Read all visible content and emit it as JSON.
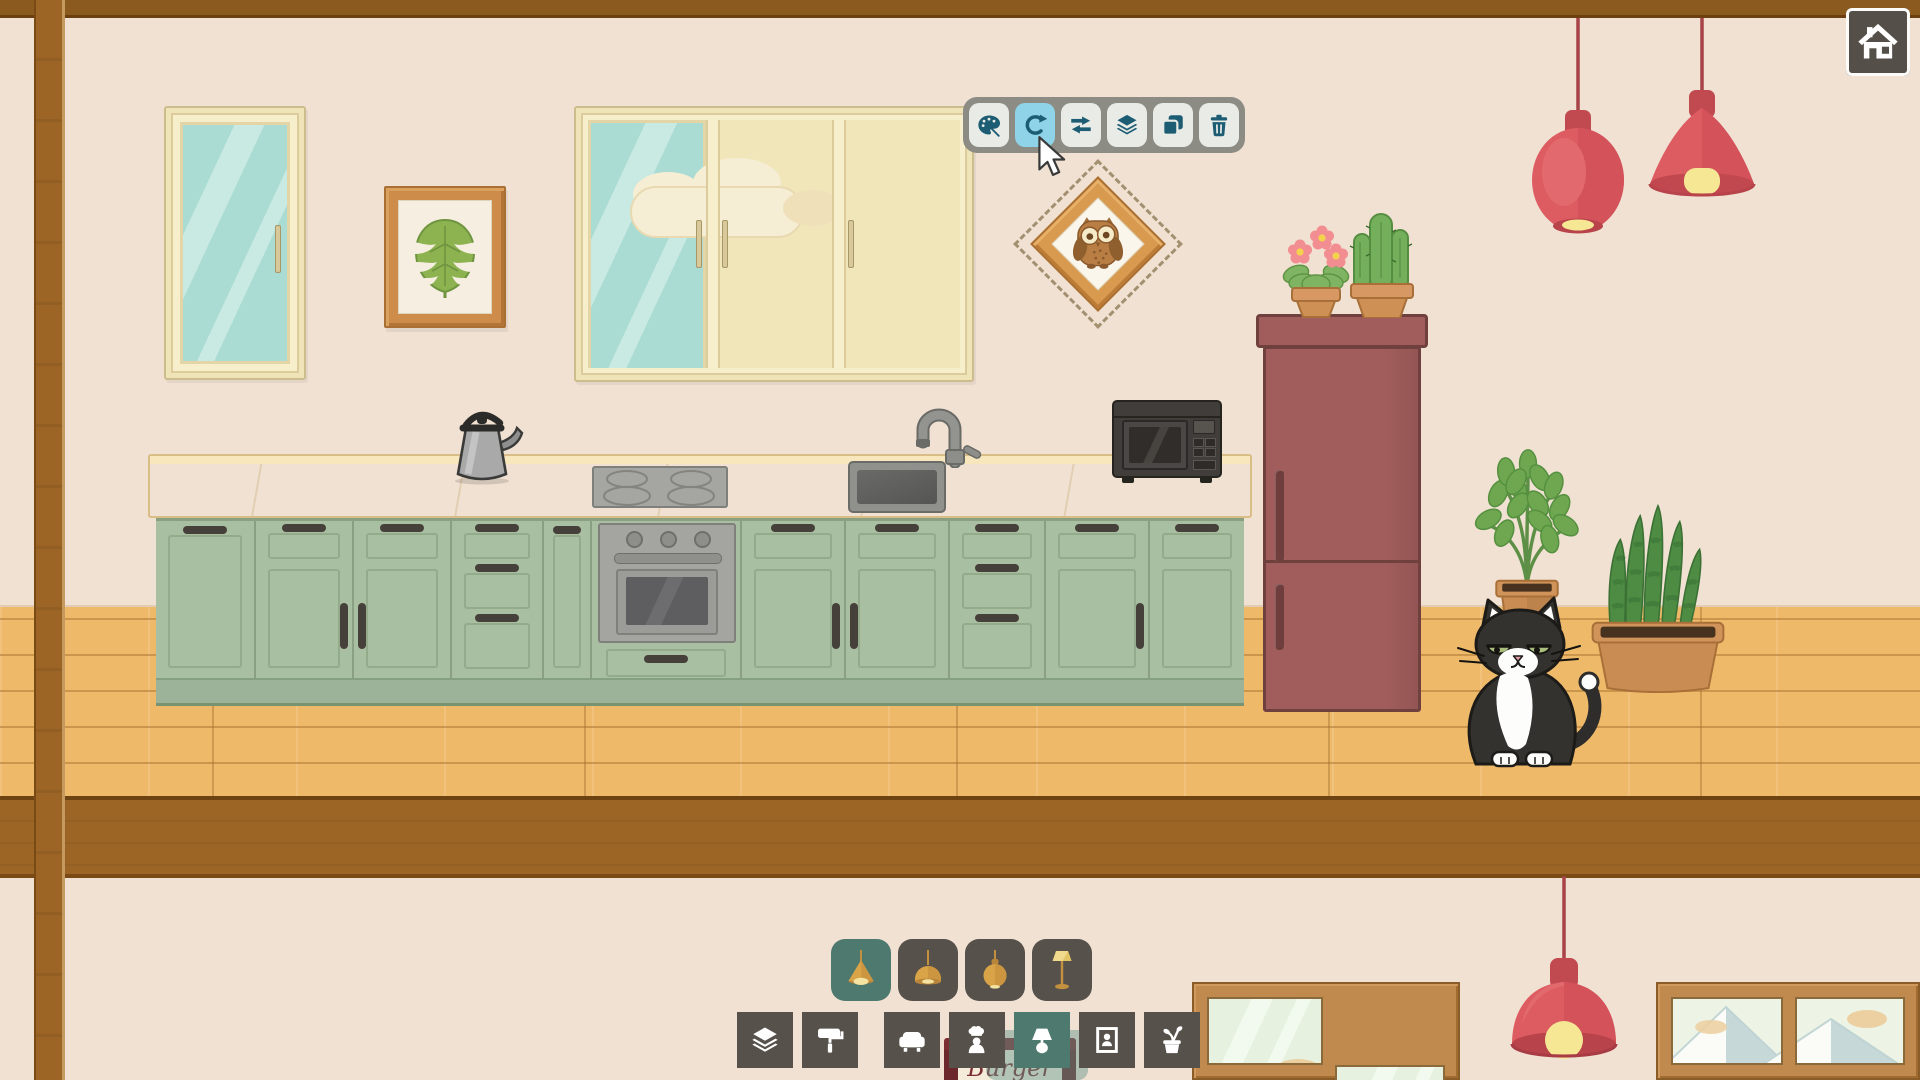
{
  "ui": {
    "home_button": {
      "icon": "home-icon"
    },
    "selection_toolbar": {
      "buttons": [
        {
          "id": "paint",
          "icon": "palette-icon",
          "active": false
        },
        {
          "id": "rotate",
          "icon": "rotate-icon",
          "active": true
        },
        {
          "id": "flip",
          "icon": "flip-arrows-icon",
          "active": false
        },
        {
          "id": "layers",
          "icon": "layers-icon",
          "active": false
        },
        {
          "id": "duplicate",
          "icon": "duplicate-icon",
          "active": false
        },
        {
          "id": "delete",
          "icon": "trash-icon",
          "active": false
        }
      ]
    },
    "item_tray": {
      "items": [
        {
          "id": "pendant-lamp-cone",
          "icon": "pendant-lamp-cone-icon",
          "selected": true
        },
        {
          "id": "pendant-lamp-dome",
          "icon": "pendant-lamp-dome-icon",
          "selected": false
        },
        {
          "id": "pendant-lamp-orb",
          "icon": "pendant-lamp-orb-icon",
          "selected": false
        },
        {
          "id": "floor-lamp",
          "icon": "floor-lamp-icon",
          "selected": false
        }
      ]
    },
    "category_bar": {
      "items": [
        {
          "id": "layers",
          "icon": "layers-icon",
          "selected": false
        },
        {
          "id": "wallpaper",
          "icon": "paint-roller-icon",
          "selected": false
        },
        {
          "id": "furniture",
          "icon": "couch-icon",
          "selected": false
        },
        {
          "id": "characters",
          "icon": "chef-icon",
          "selected": false
        },
        {
          "id": "lighting",
          "icon": "table-lamp-icon",
          "selected": true
        },
        {
          "id": "wall-decor",
          "icon": "framed-picture-icon",
          "selected": false
        },
        {
          "id": "plants",
          "icon": "potted-plant-icon",
          "selected": false
        }
      ]
    },
    "cursor": {
      "x": 1038,
      "y": 136
    }
  },
  "scene": {
    "selected_object": "owl-picture",
    "sign_text": "Burger",
    "upper_room_objects": [
      "single-window",
      "monstera-picture",
      "triple-window",
      "owl-picture",
      "kettle",
      "cooktop",
      "sink",
      "microwave",
      "oven",
      "kitchen-cabinets",
      "refrigerator",
      "flower-pot-plant",
      "cactus-plant",
      "leafy-plant",
      "snake-plant",
      "cat",
      "pendant-lamp-round",
      "pendant-lamp-cone"
    ],
    "lower_room_objects": [
      "lower-window-left",
      "red-pendant-lamp",
      "burger-sign",
      "lower-window-right"
    ]
  },
  "colors": {
    "wall": "#f0e1d2",
    "wood_beam": "#9c6526",
    "floor": "#eeba6a",
    "cabinet_green": "#a9bfa1",
    "counter": "#f2d9a6",
    "fridge_red": "#a05d5b",
    "lamp_red": "#dd5c61",
    "toolbar_icon": "#1d5d73",
    "toolbar_active": "#8fd3e8",
    "tile_dark": "#57514b",
    "tile_selected": "#4e796f",
    "sign_red": "#7c2d31",
    "window_glass": "#aadcd3",
    "frame_cream": "#f7eecb",
    "picture_wood": "#cd8c4a"
  }
}
